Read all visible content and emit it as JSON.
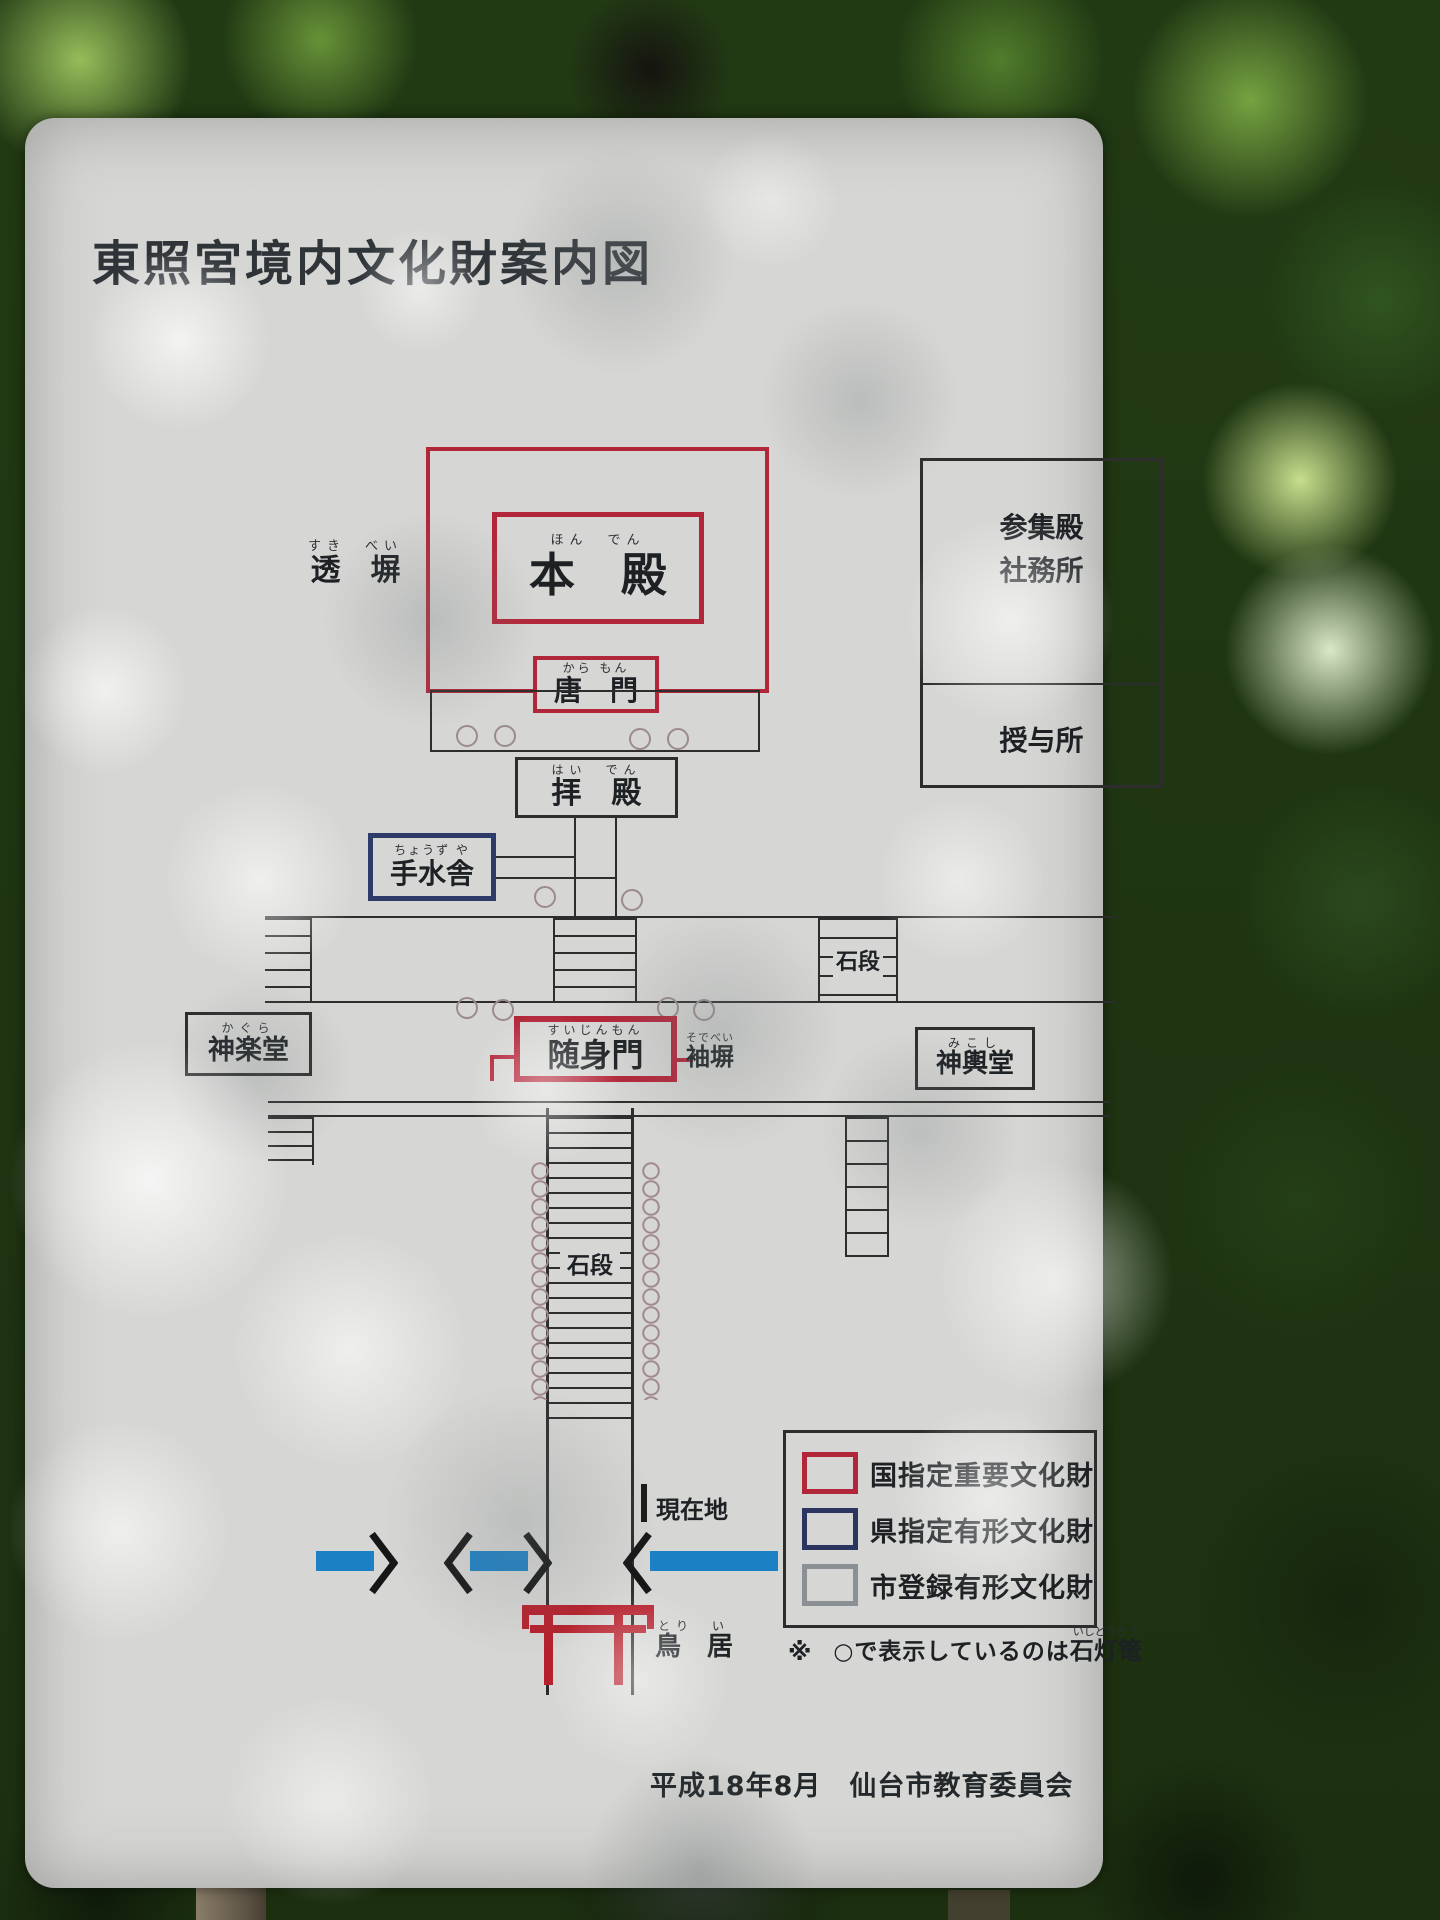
{
  "sign": {
    "title": "東照宮境内文化財案内図",
    "credit": "平成18年8月　仙台市教育委員会"
  },
  "map": {
    "sukibei": {
      "furigana": "すき　べい",
      "text": "透　塀"
    },
    "honden": {
      "furigana": "ほん　でん",
      "text": "本　殿"
    },
    "karamon": {
      "furigana": "から もん",
      "text": "唐　門"
    },
    "sanshuden_line1": "参集殿",
    "sanshuden_line2": "社務所",
    "juyosho": "授与所",
    "haiden": {
      "furigana": "はい　でん",
      "text": "拝　殿"
    },
    "chozuya": {
      "furigana": "ちょうず や",
      "text": "手水舎"
    },
    "ishidan_upper": "石段",
    "kagurado": {
      "furigana": "かぐら",
      "text": "神楽堂"
    },
    "zuijinmon": {
      "furigana": "すいじんもん",
      "text": "随身門"
    },
    "sodebei": {
      "furigana": "そでべい",
      "text": "袖塀"
    },
    "mikoshido": {
      "furigana": "みこし",
      "text": "神輿堂"
    },
    "ishidan_lower": "石段",
    "genzaichi": "現在地",
    "torii": {
      "furigana": "とり　い",
      "text": "鳥　居"
    }
  },
  "legend": {
    "items": [
      {
        "label": "国指定重要文化財",
        "color": "#b22639"
      },
      {
        "label": "県指定有形文化財",
        "color": "#2c3560"
      },
      {
        "label": "市登録有形文化財",
        "color": "#8b9095"
      }
    ],
    "note_mark": "※",
    "note_text": "○で表示しているのは",
    "note_term": {
      "furigana": "いしどうろう",
      "text": "石灯篭"
    }
  },
  "colors": {
    "national_red": "#b22639",
    "prefectural_navy": "#2c3560",
    "municipal_gray": "#8b9095",
    "road_blue": "#1b80c4",
    "torii_red": "#b5202c"
  }
}
